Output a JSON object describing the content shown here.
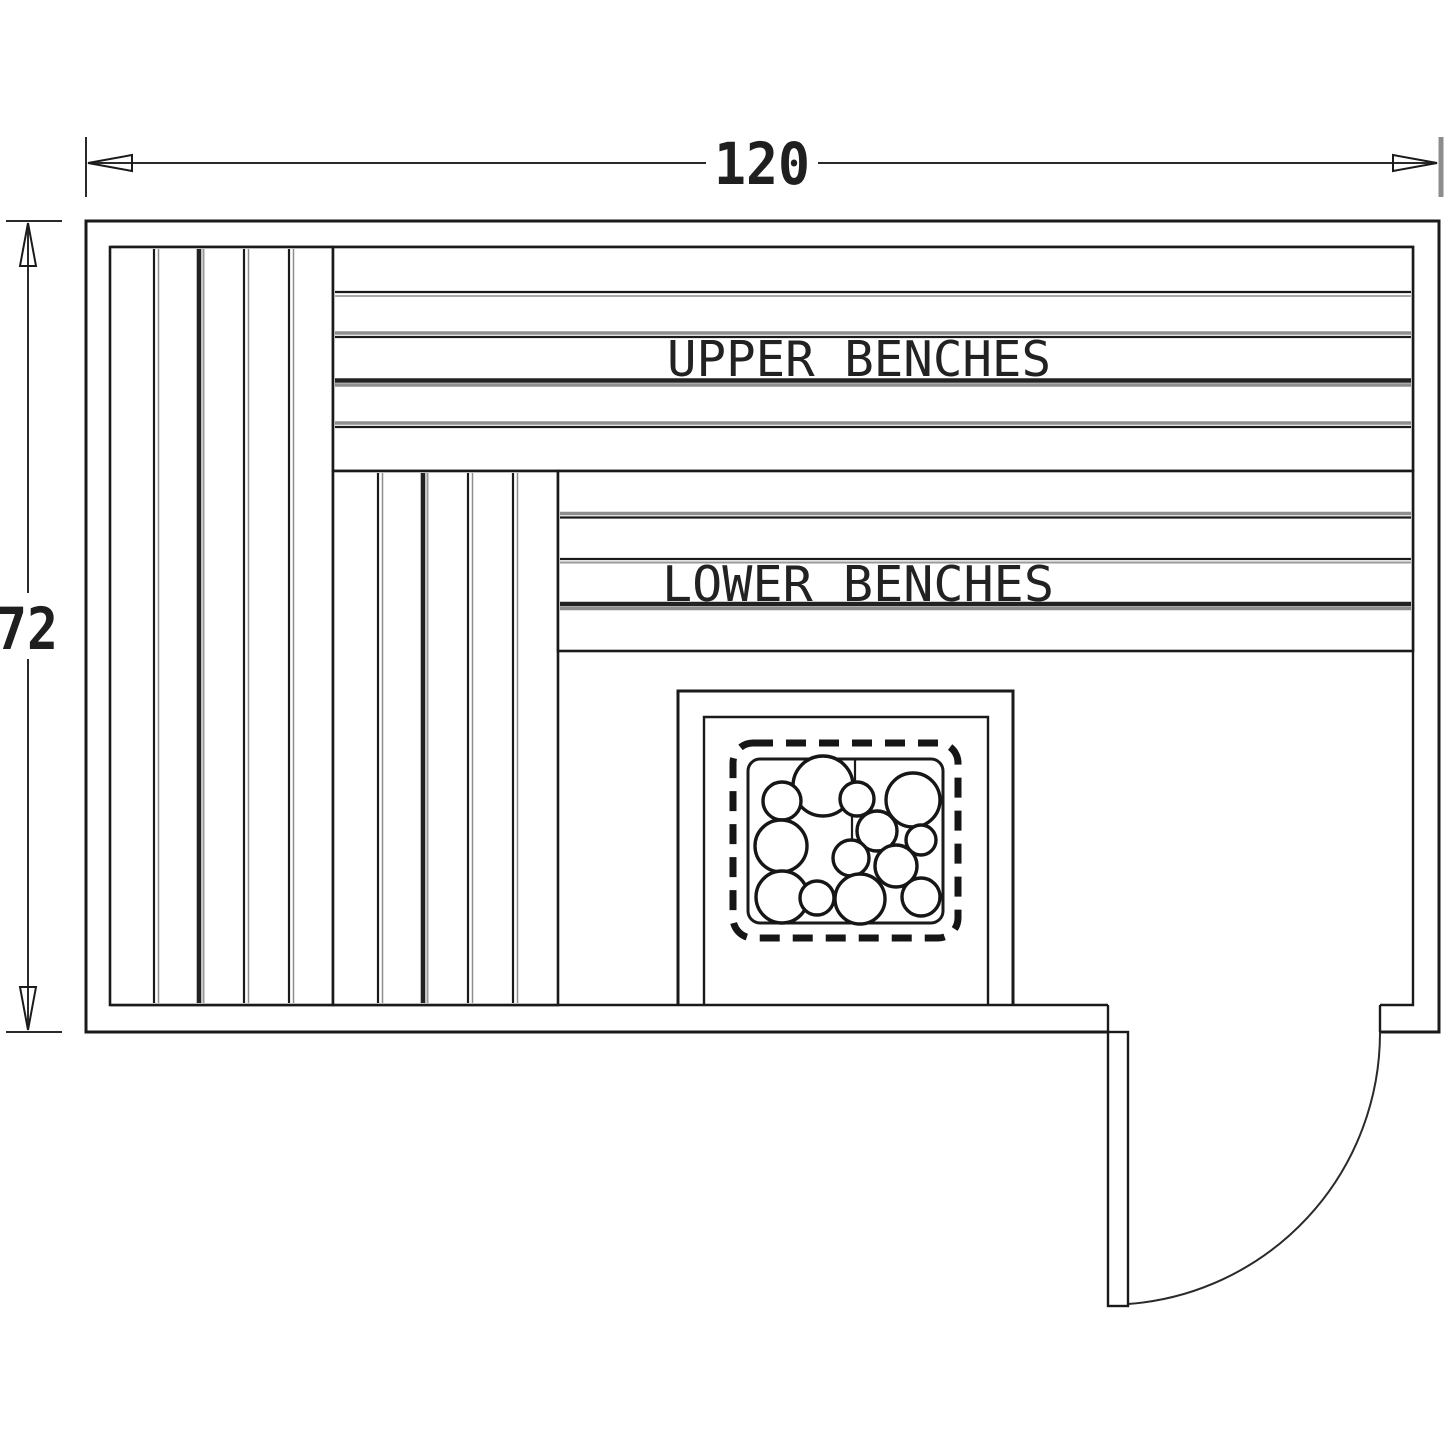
{
  "canvas": {
    "background": "#ffffff",
    "line_color": "#1a1a1a",
    "shadow_line_color": "#8e8e8e"
  },
  "dimensions": {
    "width": {
      "label": "120"
    },
    "height": {
      "label": "72"
    }
  },
  "labels": {
    "upper_benches": "UPPER BENCHES",
    "lower_benches": "LOWER BENCHES"
  }
}
